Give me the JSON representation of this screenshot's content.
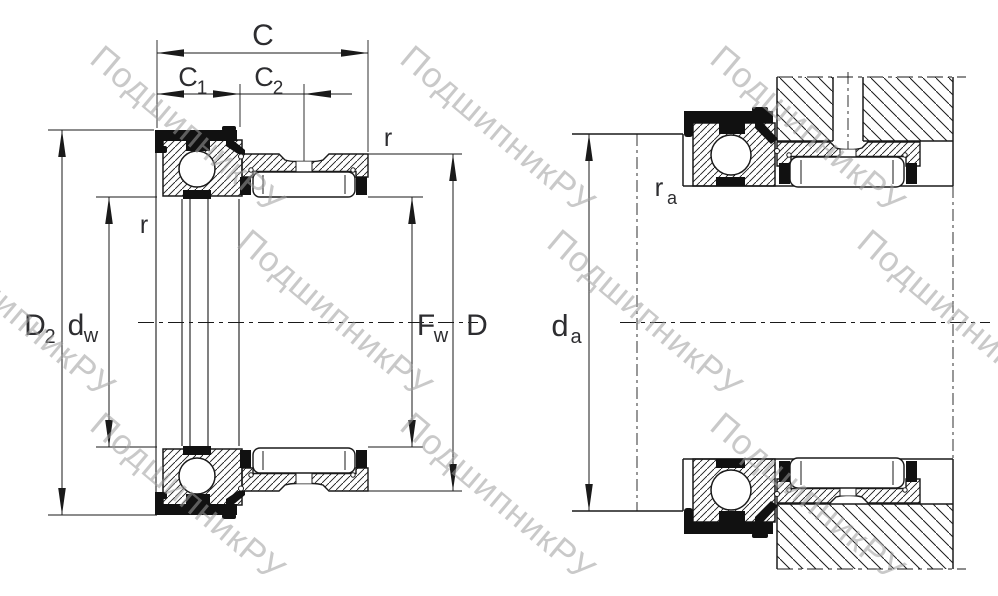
{
  "watermark": {
    "text": "ПодшипникРУ"
  },
  "colors": {
    "line": "#1a1a1a",
    "label": "#2d2d30",
    "watermark": "#9e9e9e",
    "background": "#ffffff"
  },
  "left": {
    "name": "combined needle roller / ball bearing cross-section",
    "labels": {
      "c": "C",
      "c1_base": "C",
      "c1_sub": "1",
      "c2_base": "C",
      "c2_sub": "2",
      "r_top": "r",
      "r_left": "r",
      "d2_base": "D",
      "d2_sub": "2",
      "dw_base": "d",
      "dw_sub": "w",
      "fw_base": "F",
      "fw_sub": "w",
      "d": "D"
    }
  },
  "right": {
    "name": "bearing mounted on shaft with housing",
    "labels": {
      "ra_base": "r",
      "ra_sub": "a",
      "da_base": "d",
      "da_sub": "a"
    }
  }
}
